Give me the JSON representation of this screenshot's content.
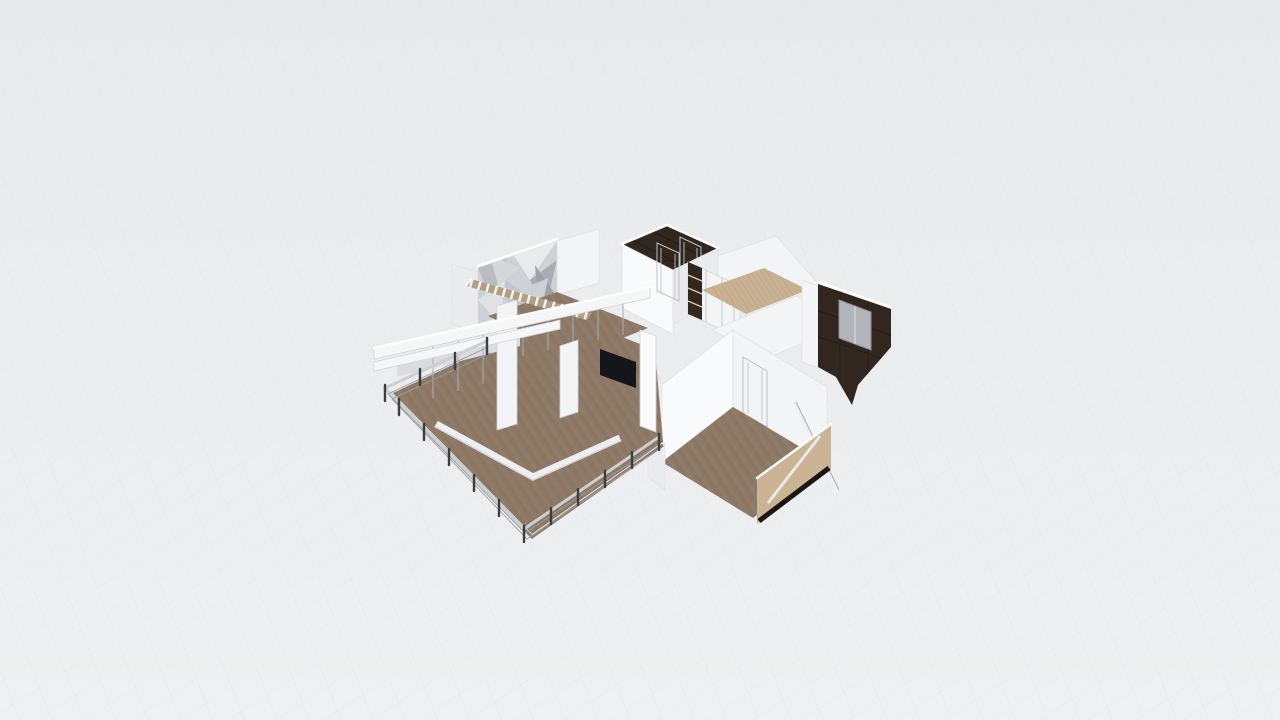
{
  "canvas": {
    "background_top": "#e8e9eb",
    "background_bottom": "#eef0f1",
    "grid_line": "#dde0e3"
  },
  "palette": {
    "wall_bright": "#f9fafb",
    "wall_white": "#f3f4f6",
    "wall_shaded": "#e9ebee",
    "wood_floor": "#8d7966",
    "wood_light": "#c9b292",
    "stair_wood": "#b3a083",
    "tile_dark": "#31271f",
    "marble_base": "#ced1d5",
    "window_glass": "#b2b5b9",
    "tan_wall": "#cbb493",
    "tv_screen": "#15161a",
    "railing_metal": "#3c3d40",
    "railing_rail": "#cdd0d3",
    "beam_white": "#f5f6f8",
    "gray_halfwall": "#dadce0",
    "door_white": "#f3f4f6"
  }
}
